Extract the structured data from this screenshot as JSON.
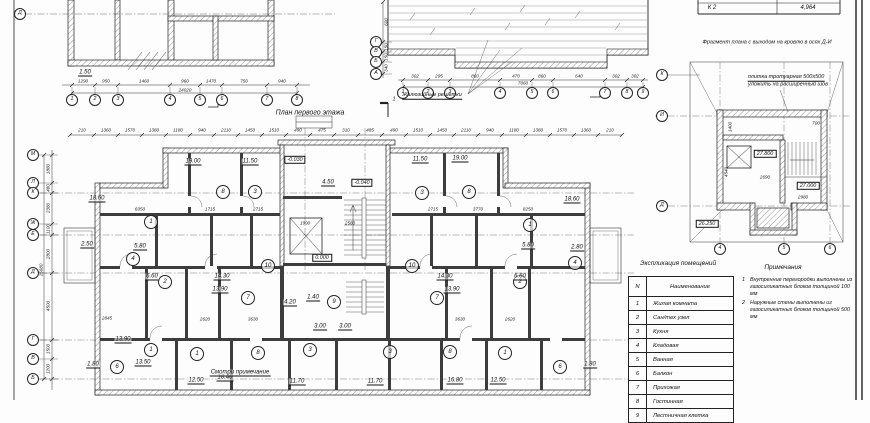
{
  "drawing": {
    "titles": {
      "plan_title": "План первого этажа",
      "fragment_title": "Фрагмент плана с выходом на кровлю в осях Д-И",
      "roof_label": "Жалюзийные решетки",
      "tile_note_1": "плитка тротуарная 500х500",
      "tile_note_2": "уложить на расширенный шов",
      "section_mark": "1"
    },
    "corner_table": {
      "c1": "К 2",
      "c2": "4,964"
    },
    "explication": {
      "title": "Экспликация помещений",
      "col_n": "N",
      "col_name": "Наименование",
      "rows": [
        {
          "n": "1",
          "name": "Жилая комната"
        },
        {
          "n": "2",
          "name": "Сан/тех узел"
        },
        {
          "n": "3",
          "name": "Кухня"
        },
        {
          "n": "4",
          "name": "Кладовая"
        },
        {
          "n": "5",
          "name": "Ванная"
        },
        {
          "n": "6",
          "name": "Балкон"
        },
        {
          "n": "7",
          "name": "Прихожая"
        },
        {
          "n": "8",
          "name": "Гостинная"
        },
        {
          "n": "9",
          "name": "Лестничная клетка"
        }
      ]
    },
    "notes": {
      "title": "Примечания",
      "items": [
        {
          "n": "1",
          "t": "Внутренние перегородки выполнены из газосиликатных блоков толщиной 100 мм"
        },
        {
          "n": "2",
          "t": "Наружные стены выполнены из газосиликатных блоков толщиной 500 мм"
        }
      ]
    },
    "axis_bubbles": [
      {
        "x": 33,
        "y": 155,
        "l": "М"
      },
      {
        "x": 33,
        "y": 183,
        "l": "Л"
      },
      {
        "x": 33,
        "y": 193,
        "l": "К"
      },
      {
        "x": 33,
        "y": 224,
        "l": "Ж"
      },
      {
        "x": 33,
        "y": 235,
        "l": "Е"
      },
      {
        "x": 33,
        "y": 273,
        "l": "Д"
      },
      {
        "x": 33,
        "y": 340,
        "l": "Г"
      },
      {
        "x": 33,
        "y": 359,
        "l": "В"
      },
      {
        "x": 33,
        "y": 379,
        "l": "Б"
      },
      {
        "x": 20,
        "y": 14,
        "l": "Д"
      },
      {
        "x": 72,
        "y": 100,
        "l": "1"
      },
      {
        "x": 95,
        "y": 100,
        "l": "2"
      },
      {
        "x": 118,
        "y": 100,
        "l": "3"
      },
      {
        "x": 170,
        "y": 100,
        "l": "4"
      },
      {
        "x": 200,
        "y": 100,
        "l": "5"
      },
      {
        "x": 222,
        "y": 100,
        "l": "6"
      },
      {
        "x": 267,
        "y": 100,
        "l": "7"
      },
      {
        "x": 297,
        "y": 100,
        "l": "8"
      },
      {
        "x": 403,
        "y": 93,
        "l": "1"
      },
      {
        "x": 428,
        "y": 93,
        "l": "2"
      },
      {
        "x": 450,
        "y": 93,
        "l": "3"
      },
      {
        "x": 500,
        "y": 93,
        "l": "4"
      },
      {
        "x": 532,
        "y": 93,
        "l": "5"
      },
      {
        "x": 553,
        "y": 93,
        "l": "6"
      },
      {
        "x": 605,
        "y": 93,
        "l": "7"
      },
      {
        "x": 627,
        "y": 93,
        "l": "8"
      },
      {
        "x": 643,
        "y": 93,
        "l": "9"
      },
      {
        "x": 376,
        "y": 42,
        "l": "Г"
      },
      {
        "x": 376,
        "y": 52,
        "l": "В"
      },
      {
        "x": 376,
        "y": 62,
        "l": "Б"
      },
      {
        "x": 376,
        "y": 74,
        "l": "А"
      },
      {
        "x": 662,
        "y": 75,
        "l": "К"
      },
      {
        "x": 662,
        "y": 116,
        "l": "И"
      },
      {
        "x": 662,
        "y": 206,
        "l": "Д"
      },
      {
        "x": 720,
        "y": 249,
        "l": "4"
      },
      {
        "x": 784,
        "y": 249,
        "l": "5"
      },
      {
        "x": 830,
        "y": 249,
        "l": "6"
      }
    ],
    "room_circles": [
      {
        "x": 151,
        "y": 222,
        "n": "1"
      },
      {
        "x": 223,
        "y": 192,
        "n": "8"
      },
      {
        "x": 255,
        "y": 192,
        "n": "3"
      },
      {
        "x": 422,
        "y": 193,
        "n": "3"
      },
      {
        "x": 469,
        "y": 192,
        "n": "8"
      },
      {
        "x": 530,
        "y": 225,
        "n": "1"
      },
      {
        "x": 133,
        "y": 259,
        "n": "4"
      },
      {
        "x": 575,
        "y": 263,
        "n": "4"
      },
      {
        "x": 268,
        "y": 266,
        "n": "10"
      },
      {
        "x": 412,
        "y": 266,
        "n": "10"
      },
      {
        "x": 165,
        "y": 282,
        "n": "2"
      },
      {
        "x": 520,
        "y": 282,
        "n": "2"
      },
      {
        "x": 248,
        "y": 298,
        "n": "7"
      },
      {
        "x": 437,
        "y": 298,
        "n": "7"
      },
      {
        "x": 334,
        "y": 302,
        "n": "9"
      },
      {
        "x": 117,
        "y": 367,
        "n": "6"
      },
      {
        "x": 151,
        "y": 350,
        "n": "1"
      },
      {
        "x": 197,
        "y": 354,
        "n": "1"
      },
      {
        "x": 258,
        "y": 353,
        "n": "8"
      },
      {
        "x": 310,
        "y": 350,
        "n": "3"
      },
      {
        "x": 390,
        "y": 352,
        "n": "3"
      },
      {
        "x": 450,
        "y": 352,
        "n": "8"
      },
      {
        "x": 505,
        "y": 353,
        "n": "1"
      },
      {
        "x": 560,
        "y": 367,
        "n": "6"
      }
    ],
    "area_labels": [
      {
        "x": 97,
        "y": 199,
        "v": "18.60"
      },
      {
        "x": 193,
        "y": 162,
        "v": "19.00"
      },
      {
        "x": 250,
        "y": 162,
        "v": "11.50"
      },
      {
        "x": 420,
        "y": 160,
        "v": "11.50"
      },
      {
        "x": 460,
        "y": 159,
        "v": "19.00"
      },
      {
        "x": 572,
        "y": 200,
        "v": "18.60"
      },
      {
        "x": 87,
        "y": 245,
        "v": "2.50"
      },
      {
        "x": 140,
        "y": 247,
        "v": "5.80"
      },
      {
        "x": 528,
        "y": 246,
        "v": "5.80"
      },
      {
        "x": 577,
        "y": 248,
        "v": "2.80"
      },
      {
        "x": 152,
        "y": 277,
        "v": "6.60"
      },
      {
        "x": 520,
        "y": 277,
        "v": "6.60"
      },
      {
        "x": 123,
        "y": 340,
        "v": "13.90"
      },
      {
        "x": 222,
        "y": 277,
        "v": "14.30"
      },
      {
        "x": 220,
        "y": 290,
        "v": "13.90"
      },
      {
        "x": 445,
        "y": 277,
        "v": "14.30"
      },
      {
        "x": 452,
        "y": 290,
        "v": "13.90"
      },
      {
        "x": 93,
        "y": 365,
        "v": "1.80"
      },
      {
        "x": 143,
        "y": 363,
        "v": "13.50"
      },
      {
        "x": 196,
        "y": 381,
        "v": "12.50"
      },
      {
        "x": 225,
        "y": 378,
        "v": "18.40"
      },
      {
        "x": 297,
        "y": 382,
        "v": "11.70"
      },
      {
        "x": 375,
        "y": 382,
        "v": "11.70"
      },
      {
        "x": 455,
        "y": 381,
        "v": "16.80"
      },
      {
        "x": 498,
        "y": 381,
        "v": "12.50"
      },
      {
        "x": 590,
        "y": 365,
        "v": "1.80"
      },
      {
        "x": 328,
        "y": 183,
        "v": "4.50"
      },
      {
        "x": 313,
        "y": 298,
        "v": "1.40"
      },
      {
        "x": 290,
        "y": 303,
        "v": "4.20"
      },
      {
        "x": 320,
        "y": 327,
        "v": "3.00"
      },
      {
        "x": 345,
        "y": 327,
        "v": "3.00"
      },
      {
        "x": 85,
        "y": 73,
        "v": "1.50"
      },
      {
        "x": 240,
        "y": 373,
        "v": "Смотри примечание"
      }
    ],
    "dim_labels": [
      {
        "x": 82,
        "y": 131,
        "v": "210"
      },
      {
        "x": 106,
        "y": 131,
        "v": "1360"
      },
      {
        "x": 130,
        "y": 131,
        "v": "1570"
      },
      {
        "x": 154,
        "y": 131,
        "v": "1380"
      },
      {
        "x": 178,
        "y": 131,
        "v": "1180"
      },
      {
        "x": 202,
        "y": 131,
        "v": "940"
      },
      {
        "x": 226,
        "y": 131,
        "v": "2110"
      },
      {
        "x": 250,
        "y": 131,
        "v": "1450"
      },
      {
        "x": 274,
        "y": 131,
        "v": "1510"
      },
      {
        "x": 298,
        "y": 131,
        "v": "490"
      },
      {
        "x": 322,
        "y": 131,
        "v": "475"
      },
      {
        "x": 346,
        "y": 131,
        "v": "310"
      },
      {
        "x": 370,
        "y": 131,
        "v": "485"
      },
      {
        "x": 394,
        "y": 131,
        "v": "490"
      },
      {
        "x": 418,
        "y": 131,
        "v": "1510"
      },
      {
        "x": 442,
        "y": 131,
        "v": "1450"
      },
      {
        "x": 466,
        "y": 131,
        "v": "2110"
      },
      {
        "x": 490,
        "y": 131,
        "v": "940"
      },
      {
        "x": 514,
        "y": 131,
        "v": "1180"
      },
      {
        "x": 538,
        "y": 131,
        "v": "1380"
      },
      {
        "x": 562,
        "y": 131,
        "v": "1570"
      },
      {
        "x": 586,
        "y": 131,
        "v": "1360"
      },
      {
        "x": 610,
        "y": 131,
        "v": "210"
      },
      {
        "x": 49,
        "y": 169,
        "v": "1880",
        "r": -90
      },
      {
        "x": 49,
        "y": 188,
        "v": "480",
        "r": -90
      },
      {
        "x": 49,
        "y": 208,
        "v": "2380",
        "r": -90
      },
      {
        "x": 49,
        "y": 229,
        "v": "1100",
        "r": -90
      },
      {
        "x": 49,
        "y": 254,
        "v": "2800",
        "r": -90
      },
      {
        "x": 49,
        "y": 306,
        "v": "4500",
        "r": -90
      },
      {
        "x": 49,
        "y": 349,
        "v": "1500",
        "r": -90
      },
      {
        "x": 49,
        "y": 369,
        "v": "1200",
        "r": -90
      },
      {
        "x": 42,
        "y": 270,
        "v": "15680",
        "r": -90
      },
      {
        "x": 83,
        "y": 82,
        "v": "1290"
      },
      {
        "x": 106,
        "y": 82,
        "v": "950"
      },
      {
        "x": 144,
        "y": 82,
        "v": "1460"
      },
      {
        "x": 185,
        "y": 82,
        "v": "960"
      },
      {
        "x": 211,
        "y": 82,
        "v": "1470"
      },
      {
        "x": 244,
        "y": 82,
        "v": "750"
      },
      {
        "x": 282,
        "y": 82,
        "v": "940"
      },
      {
        "x": 185,
        "y": 91,
        "v": "24020"
      },
      {
        "x": 415,
        "y": 77,
        "v": "302"
      },
      {
        "x": 439,
        "y": 77,
        "v": "295"
      },
      {
        "x": 475,
        "y": 77,
        "v": "860"
      },
      {
        "x": 516,
        "y": 77,
        "v": "470"
      },
      {
        "x": 542,
        "y": 77,
        "v": "860"
      },
      {
        "x": 579,
        "y": 77,
        "v": "640"
      },
      {
        "x": 616,
        "y": 77,
        "v": "302"
      },
      {
        "x": 635,
        "y": 77,
        "v": "302"
      },
      {
        "x": 523,
        "y": 84,
        "v": "7060"
      },
      {
        "x": 387,
        "y": 22,
        "v": "600",
        "r": -90
      },
      {
        "x": 387,
        "y": 47,
        "v": "150",
        "r": -90
      },
      {
        "x": 387,
        "y": 57,
        "v": "150",
        "r": -90
      },
      {
        "x": 387,
        "y": 68,
        "v": "340",
        "r": -90
      },
      {
        "x": 140,
        "y": 210,
        "v": "6050"
      },
      {
        "x": 210,
        "y": 210,
        "v": "1715"
      },
      {
        "x": 258,
        "y": 210,
        "v": "2715"
      },
      {
        "x": 433,
        "y": 210,
        "v": "2715"
      },
      {
        "x": 478,
        "y": 210,
        "v": "3770"
      },
      {
        "x": 528,
        "y": 210,
        "v": "8250"
      },
      {
        "x": 107,
        "y": 319,
        "v": "2845"
      },
      {
        "x": 205,
        "y": 320,
        "v": "2620"
      },
      {
        "x": 253,
        "y": 320,
        "v": "3630"
      },
      {
        "x": 460,
        "y": 320,
        "v": "3630"
      },
      {
        "x": 510,
        "y": 320,
        "v": "2620"
      },
      {
        "x": 305,
        "y": 224,
        "v": "1900"
      },
      {
        "x": 350,
        "y": 224,
        "v": "2580"
      },
      {
        "x": 765,
        "y": 178,
        "v": "2690"
      },
      {
        "x": 803,
        "y": 198,
        "v": "2980"
      },
      {
        "x": 727,
        "y": 172,
        "v": "4540",
        "r": -90
      },
      {
        "x": 731,
        "y": 127,
        "v": "1400",
        "r": -90
      },
      {
        "x": 816,
        "y": 124,
        "v": "700"
      }
    ],
    "elevation_boxes": [
      {
        "x": 295,
        "y": 160,
        "v": "-0.030"
      },
      {
        "x": 362,
        "y": 183,
        "v": "-0.040"
      },
      {
        "x": 322,
        "y": 258,
        "v": "0.000"
      },
      {
        "x": 765,
        "y": 154,
        "v": "27.800"
      },
      {
        "x": 808,
        "y": 186,
        "v": "27.000"
      },
      {
        "x": 707,
        "y": 224,
        "v": "26.250"
      }
    ]
  }
}
